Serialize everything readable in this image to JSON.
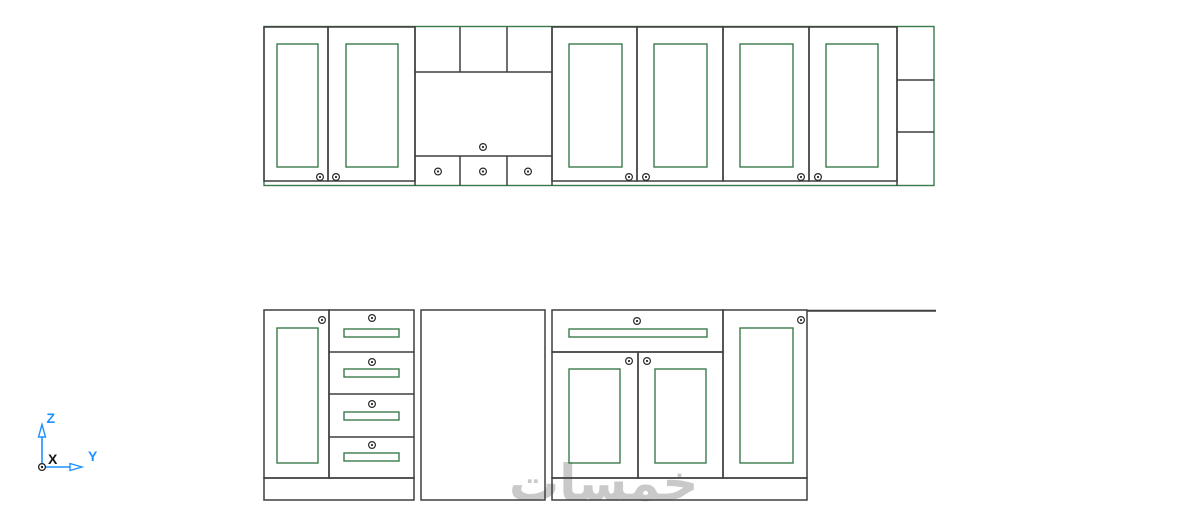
{
  "canvas": {
    "width": 1200,
    "height": 510,
    "background": "#ffffff"
  },
  "colors": {
    "line_dark": "#3f3f3f",
    "cabinet_green": "#3a7a4a",
    "axis_blue": "#1e90ff",
    "axis_x_black": "#151515",
    "watermark_gray": "#c9c9c9"
  },
  "watermark": {
    "text": "خمسات"
  },
  "ucs_icon": {
    "z_label": "Z",
    "y_label": "Y",
    "x_label": "X"
  },
  "drawing_summary": {
    "type": "cad-kitchen-cabinet-elevation",
    "upper_row": "6 framed doors with knobs, hood section with 3 top compartments and 3 bottom flaps, open shelf with 3 compartments",
    "base_row": "door with 4-drawer stack on plinth, appliance gap, wide drawer over two doors, tall door, countertop line"
  }
}
